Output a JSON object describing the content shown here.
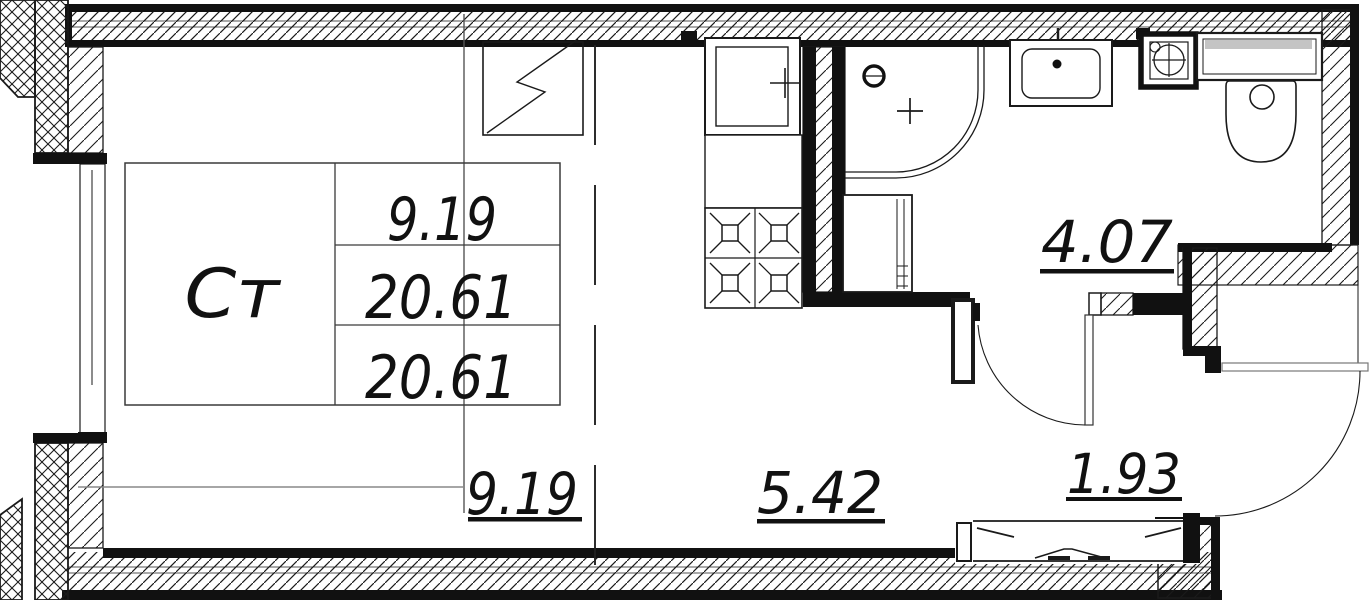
{
  "unit": {
    "type_label": "Ст",
    "living_area": "9.19",
    "total_area": "20.61",
    "reduced_total_area": "20.61"
  },
  "rooms": {
    "living": "9.19",
    "kitchen": "5.42",
    "bathroom": "4.07",
    "hallway": "1.93"
  },
  "colors": {
    "line": "#1a1a1a",
    "gray_line": "#888888",
    "cistern_shade": "#c4c4c4"
  }
}
